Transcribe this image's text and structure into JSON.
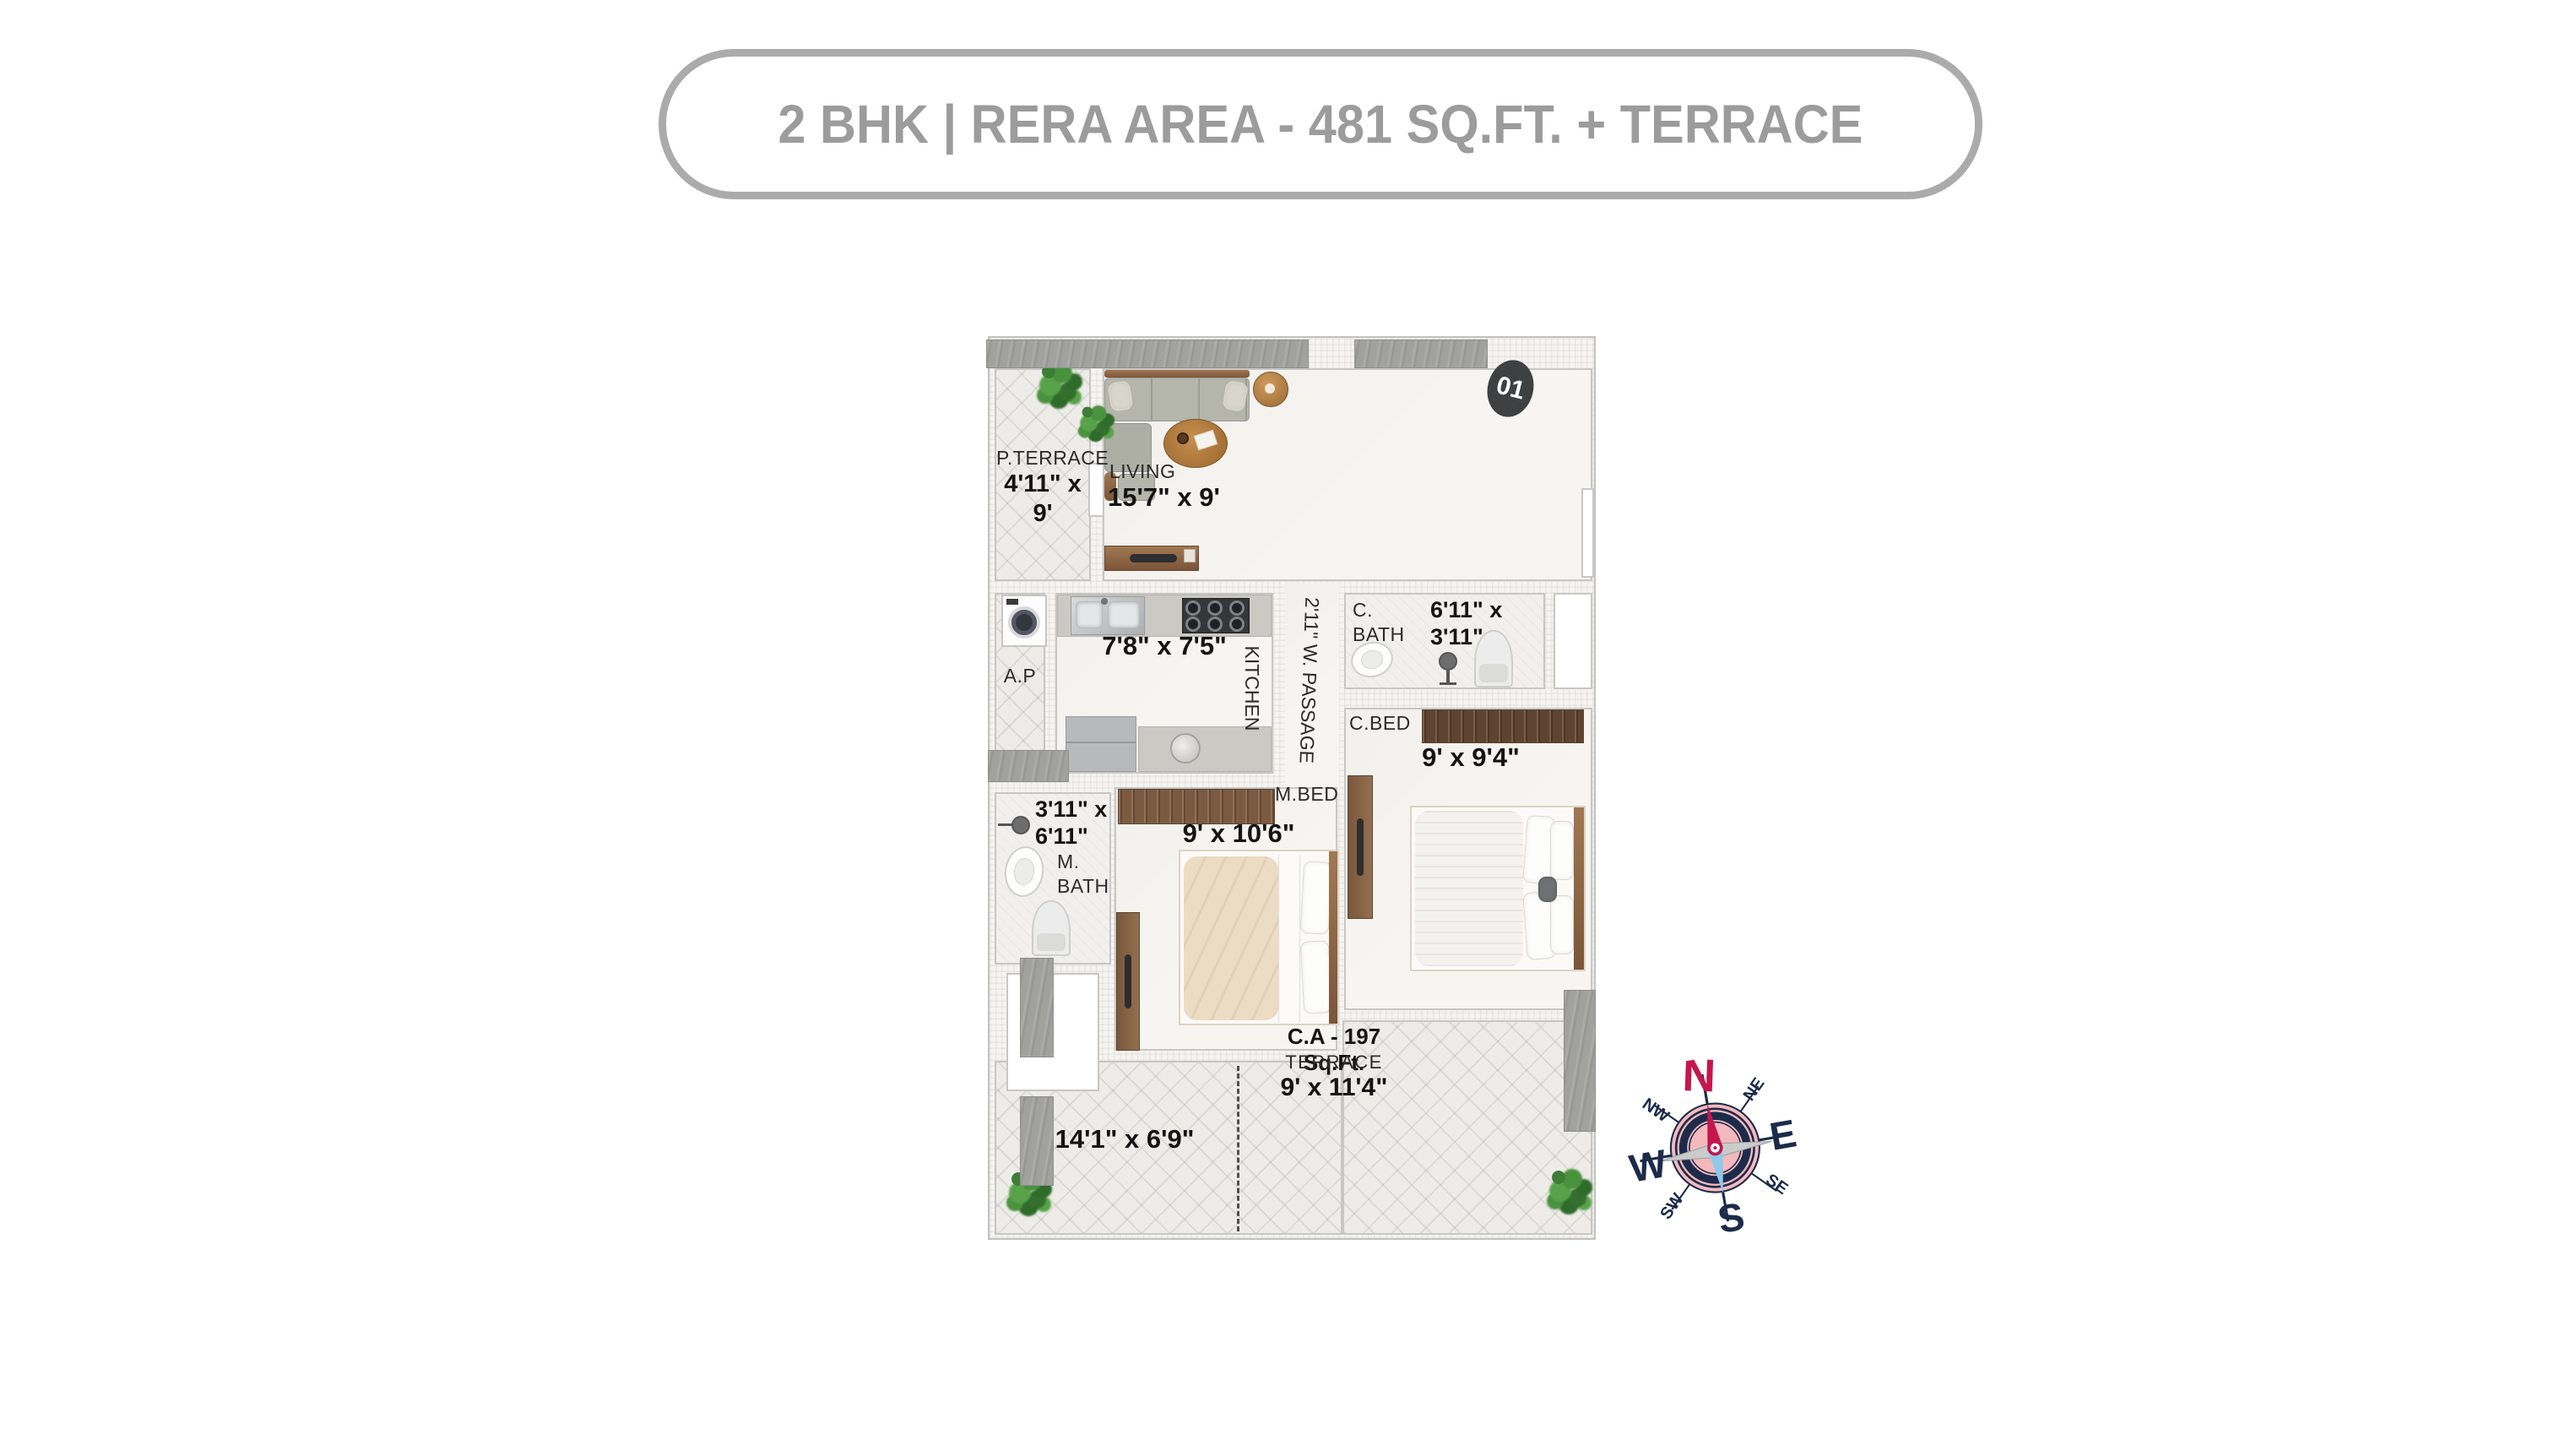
{
  "title": "2 BHK | RERA AREA - 481 SQ.FT. + TERRACE",
  "unit_badge": "01",
  "rooms": {
    "p_terrace": {
      "name": "P.TERRACE",
      "dims": "4'11\" x 9'"
    },
    "living": {
      "name": "LIVING",
      "dims": "15'7\" x 9'"
    },
    "kitchen": {
      "name": "KITCHEN",
      "dims": "7'8\" x 7'5\""
    },
    "passage": {
      "name": "2'11\" W. PASSAGE"
    },
    "ap": {
      "name": "A.P"
    },
    "c_bath": {
      "name": "C. BATH",
      "dims": "6'11\" x 3'11\""
    },
    "c_bed": {
      "name": "C.BED",
      "dims": "9' x 9'4\""
    },
    "m_bath": {
      "name": "M. BATH",
      "dims": "3'11\" x 6'11\""
    },
    "m_bed": {
      "name": "M.BED",
      "dims": "9' x 10'6\""
    },
    "terrace_left": {
      "dims": "14'1\" x 6'9\""
    },
    "terrace_right": {
      "area": "C.A - 197 Sq.Ft.",
      "name": "TERRACE",
      "dims": "9' x 11'4\""
    }
  },
  "compass": {
    "n": "N",
    "ne": "NE",
    "e": "E",
    "se": "SE",
    "s": "S",
    "sw": "SW",
    "w": "W",
    "nw": "NW"
  },
  "colors": {
    "title_gray": "#9c9c9c",
    "badge_charcoal": "#3f4041",
    "compass_red": "#c5164e",
    "compass_navy": "#1c2b4a",
    "compass_pink": "#f3b9bd",
    "wood_brown": "#8a6a4e"
  }
}
